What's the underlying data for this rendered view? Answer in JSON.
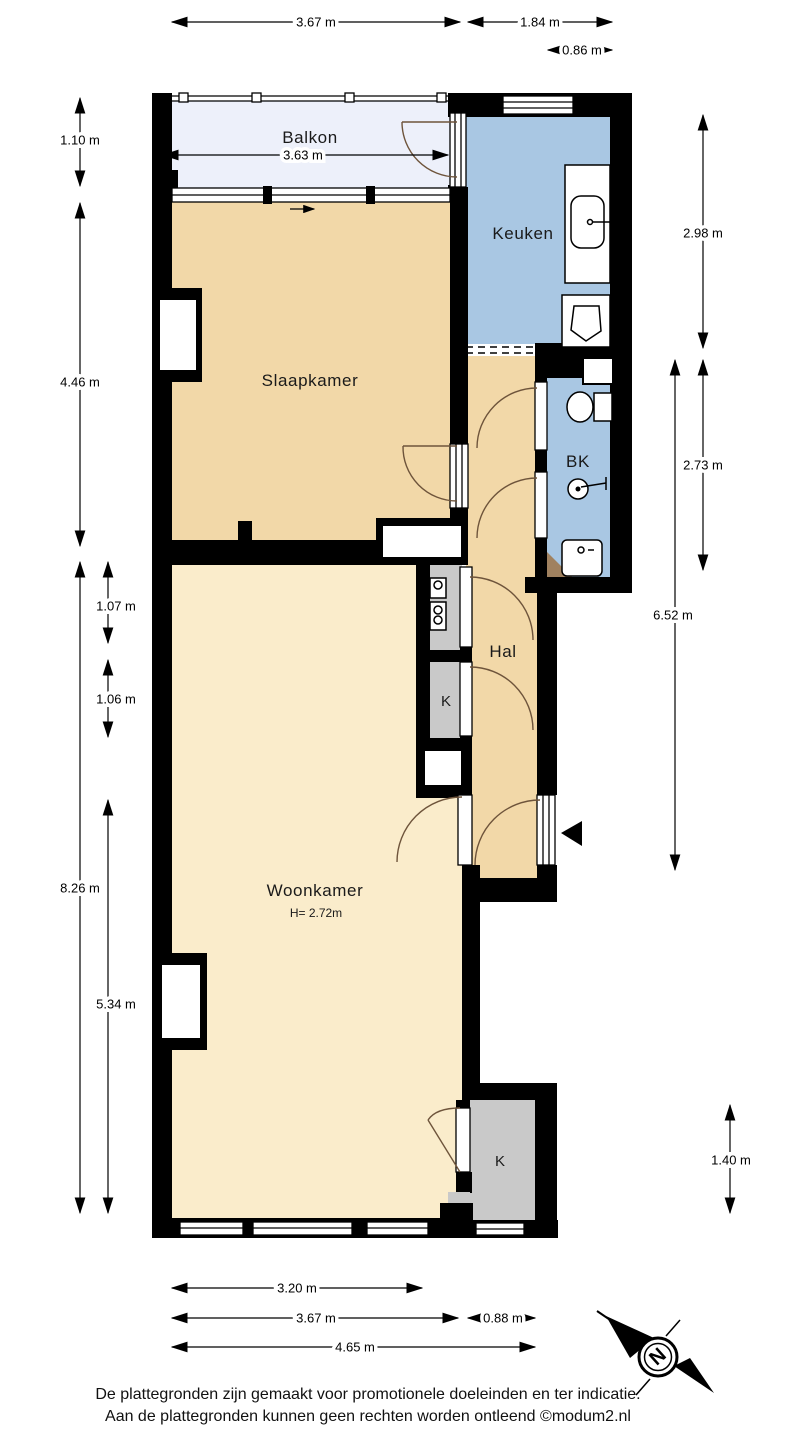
{
  "rooms": {
    "balkon": "Balkon",
    "keuken": "Keuken",
    "slaapkamer": "Slaapkamer",
    "bk": "BK",
    "hal": "Hal",
    "kast_mid": "K",
    "woonkamer": "Woonkamer",
    "woonkamer_height": "H= 2.72m",
    "kast_bottom": "K"
  },
  "dimensions": {
    "top_1": "3.67 m",
    "top_2": "1.84 m",
    "top_3": "0.86 m",
    "balkon_width": "3.63 m",
    "left_1": "1.10 m",
    "left_2": "4.46 m",
    "left_3": "1.07 m",
    "left_4": "1.06 m",
    "left_5": "8.26 m",
    "left_6": "5.34 m",
    "right_1": "2.98 m",
    "right_2": "2.73 m",
    "right_3": "6.52 m",
    "right_4": "1.40 m",
    "bottom_1": "3.20 m",
    "bottom_2": "3.67 m",
    "bottom_3": "0.88 m",
    "bottom_4": "4.65 m"
  },
  "compass": {
    "north_label": "N"
  },
  "footer": {
    "line1": "De plattegronden zijn gemaakt voor promotionele doeleinden en ter indicatie.",
    "line2": "Aan de plattegronden kunnen geen rechten worden ontleend ©modum2.nl"
  },
  "colors": {
    "balcony_fill": "#edf0fa",
    "wet_room_fill": "#a9c7e3",
    "hall_bedroom_fill": "#f2d8a8",
    "living_fill": "#faeccb",
    "closet_fill": "#c9c9c9",
    "wall": "#000000",
    "door_arc": "#6e543b",
    "shower_floor": "#a0815f"
  }
}
